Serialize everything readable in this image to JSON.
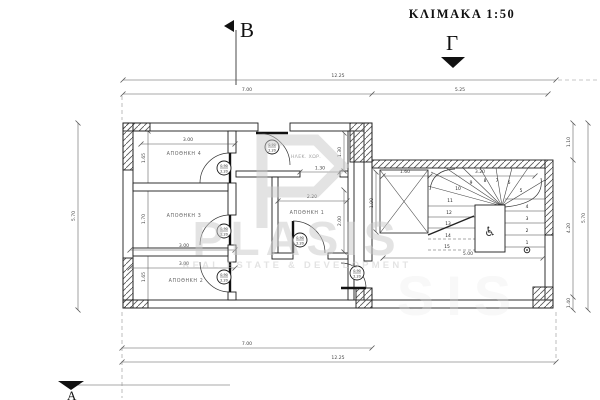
{
  "title": "ΚΛΙΜΑΚΑ 1:50",
  "section_markers": {
    "b": "B",
    "gamma": "Γ",
    "alpha": "Α"
  },
  "watermark": {
    "name": "PLASIS",
    "name_partial": "SIS",
    "tagline": "REAL ESTATE & DEVELOPMENT"
  },
  "rooms": {
    "r1": "ΑΠΟΘΗΚΗ 1",
    "r2": "ΑΠΟΘΗΚΗ 2",
    "r3": "ΑΠΟΘΗΚΗ 3",
    "r4": "ΑΠΟΘΗΚΗ 4",
    "hall": "ΗΛΕΚ. ΧΩΡ."
  },
  "dims": {
    "top_overall": "12.25",
    "top_left": "7.00",
    "top_right": "5.25",
    "bottom_left": "7.00",
    "bottom_overall": "12.25",
    "left_overall": "5.70",
    "room4_h": "1.65",
    "room3_h": "1.70",
    "room2_h": "1.65",
    "room4_w": "3.00",
    "room3_w": "3.00",
    "room2_w": "3.00",
    "room1_w": "2.20",
    "room1_h": "2.00",
    "hall_h": "1.30",
    "hall_w": "1.30",
    "niche_h": "1.90",
    "stair_left_w": "1.60",
    "stair_right_w": "3.20",
    "stair_bottom_w": "5.00",
    "right_top": "1.10",
    "right_mid": "4.20",
    "right_bottom": "1.40",
    "right_overall": "5.70"
  },
  "door_tag": {
    "w": "0.90",
    "h": "2.20"
  },
  "stair": {
    "numbers": [
      "1",
      "2",
      "3",
      "4",
      "5",
      "6",
      "7",
      "8",
      "9",
      "10",
      "11",
      "12",
      "13",
      "14",
      "15"
    ],
    "wheelchair_icon": "♿"
  },
  "colors": {
    "line": "#1c1c1c",
    "dim_text": "#444444",
    "watermark": "#c9c9c9",
    "background": "#ffffff"
  }
}
